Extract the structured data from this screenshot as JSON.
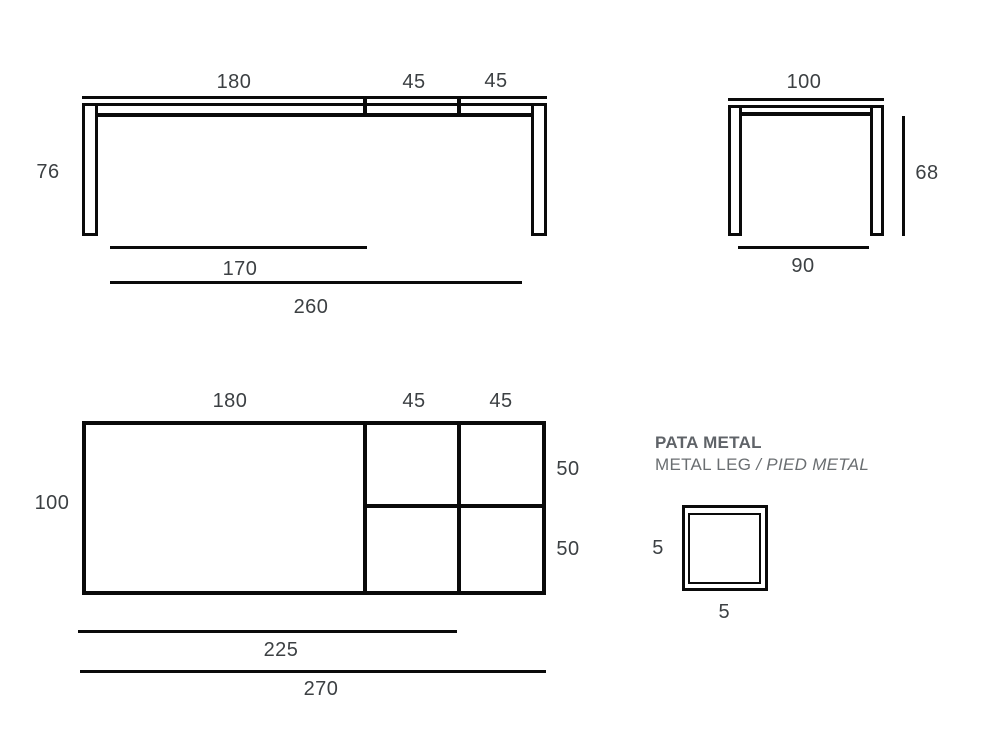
{
  "document": {
    "type": "furniture dimension drawing",
    "units_implied": "cm"
  },
  "colors": {
    "line": "#0a0a0a",
    "dim_text": "#3c4043",
    "heading_bold": "#5f6368",
    "heading_light": "#6a6e71",
    "background": "#ffffff"
  },
  "front_view": {
    "description": "front elevation of extendable table with two extension leaves",
    "dims": {
      "section_main": "180",
      "section_ext1": "45",
      "section_ext2": "45",
      "height": "76",
      "inner_length": "170",
      "total_length": "260"
    }
  },
  "side_view": {
    "description": "side elevation of table",
    "dims": {
      "depth": "100",
      "leg_height": "68",
      "inner_depth": "90"
    }
  },
  "top_view": {
    "description": "plan view of tabletop with extension leaves",
    "dims": {
      "section_main": "180",
      "section_ext1": "45",
      "section_ext2": "45",
      "depth": "100",
      "ext_depth_top": "50",
      "ext_depth_bottom": "50",
      "inner_length": "225",
      "total_length": "270"
    }
  },
  "leg_detail": {
    "title_primary": "PATA METAL",
    "title_secondary": "METAL LEG",
    "title_tertiary": " / PIED METAL",
    "dims": {
      "width": "5",
      "height": "5"
    }
  }
}
